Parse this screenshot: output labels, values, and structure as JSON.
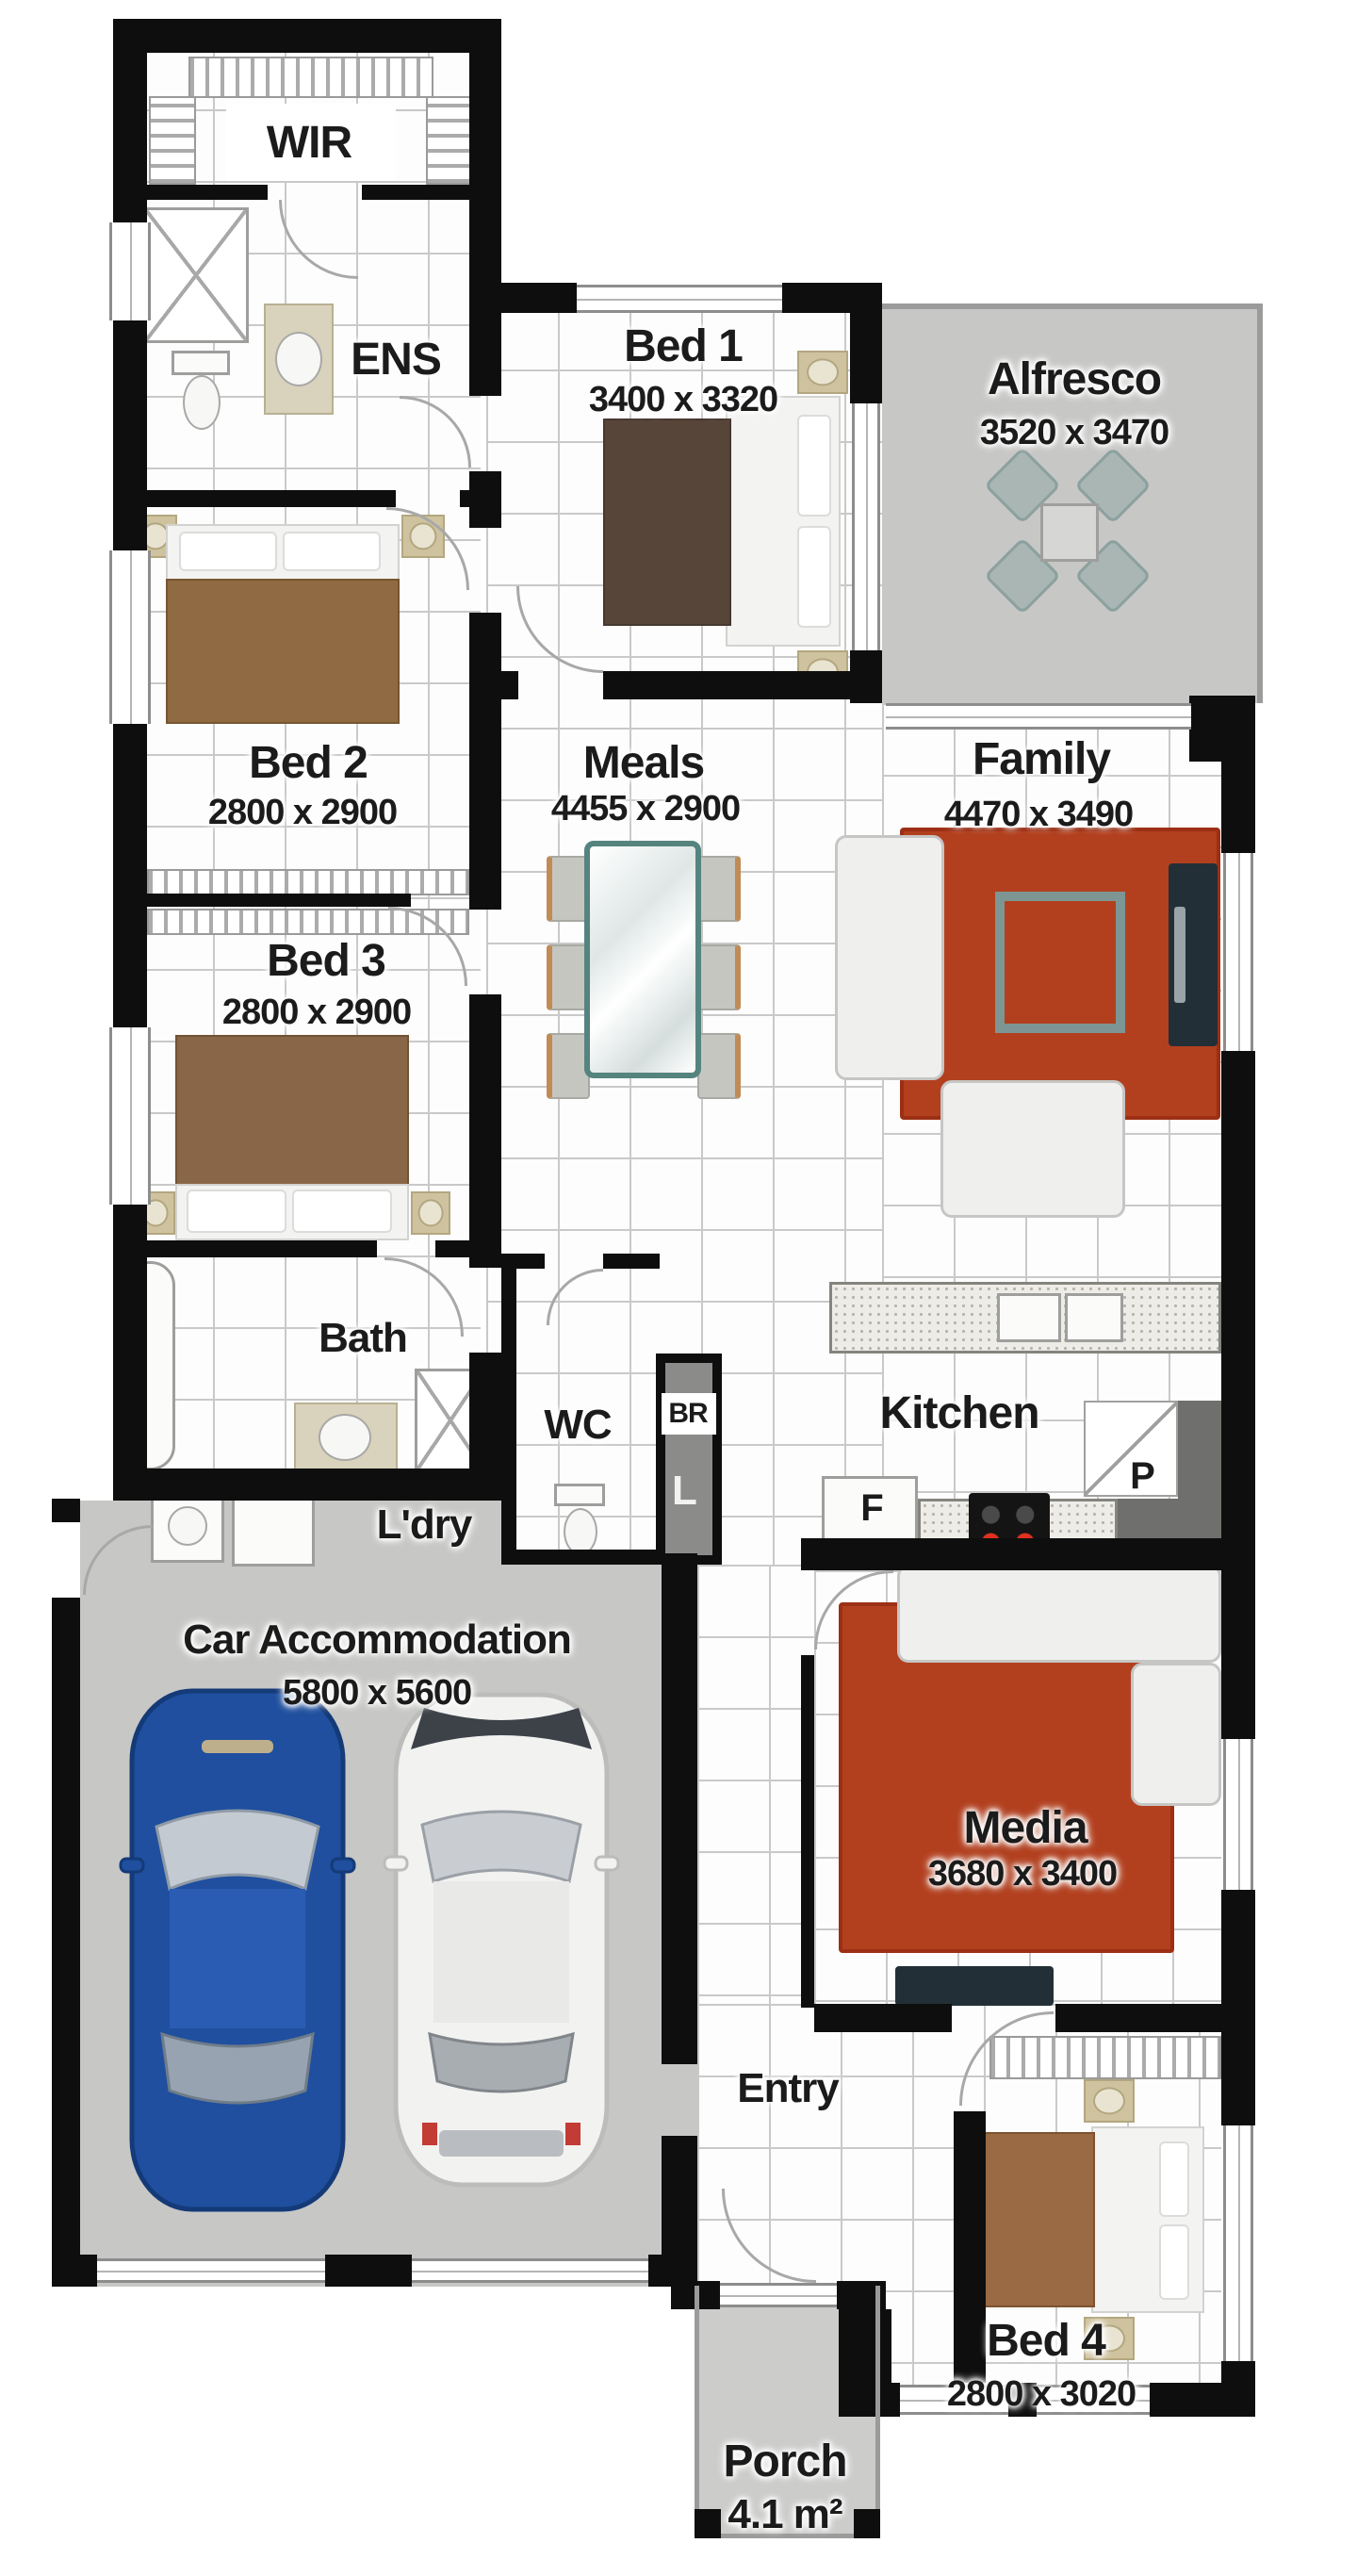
{
  "plan_title": "house floor plan",
  "rooms": {
    "wir": {
      "label": "WIR"
    },
    "ens": {
      "label": "ENS"
    },
    "bed1": {
      "label": "Bed 1",
      "dims": "3400 x 3320"
    },
    "alfresco": {
      "label": "Alfresco",
      "dims": "3520 x 3470"
    },
    "bed2": {
      "label": "Bed 2",
      "dims": "2800 x 2900"
    },
    "meals": {
      "label": "Meals",
      "dims": "4455 x 2900"
    },
    "family": {
      "label": "Family",
      "dims": "4470 x 3490"
    },
    "bed3": {
      "label": "Bed 3",
      "dims": "2800 x 2900"
    },
    "bath": {
      "label": "Bath"
    },
    "wc": {
      "label": "WC"
    },
    "broom": {
      "label": "BR"
    },
    "linen": {
      "label": "L"
    },
    "kitchen": {
      "label": "Kitchen"
    },
    "fridge": {
      "label": "F"
    },
    "pantry": {
      "label": "P"
    },
    "laundry": {
      "label": "L'dry"
    },
    "garage": {
      "label": "Car Accommodation",
      "dims": "5800 x 5600"
    },
    "media": {
      "label": "Media",
      "dims": "3680 x 3400"
    },
    "entry": {
      "label": "Entry"
    },
    "bed4": {
      "label": "Bed 4",
      "dims": "2800 x 3020"
    },
    "porch": {
      "label": "Porch",
      "dims": "4.1 m²"
    }
  },
  "colors": {
    "wall": "#0e0e0e",
    "tile_floor": "#fdfdfd",
    "outdoor_floor": "#c7c7c5",
    "rug_red": "#b2401f",
    "bed_brown_dark": "#584539",
    "bed_brown": "#8f6a42",
    "sofa_white": "#efefed",
    "car_blue": "#1f4f9e",
    "car_white": "#f2f2f1",
    "cooktop_red": "#e03020",
    "tv_dark": "#232f37"
  }
}
